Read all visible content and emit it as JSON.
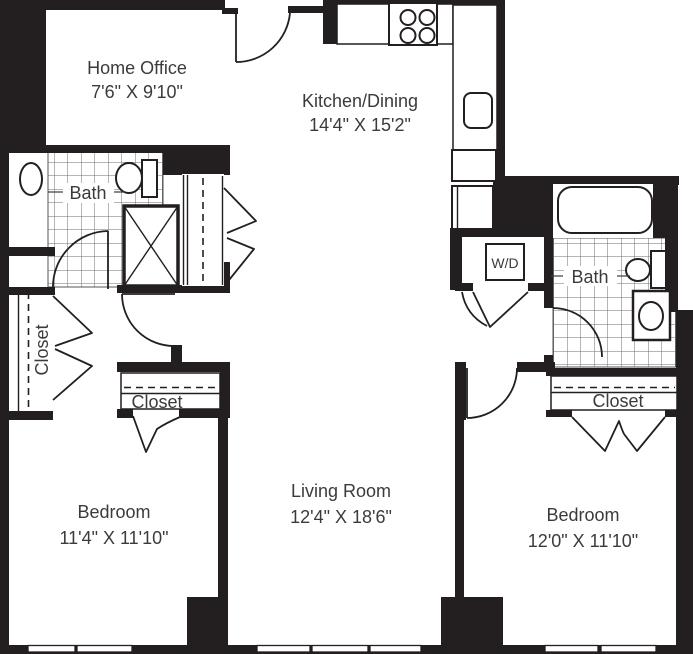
{
  "plan_title": "Two Bedroom Floor Plan",
  "colors": {
    "wall": "#231f20",
    "floor": "#ffffff",
    "tile_line": "#6e6e6e",
    "label": "#3b3b3b"
  },
  "rooms": {
    "home_office": {
      "label": "Home Office",
      "dims": "7'6\" X 9'10\""
    },
    "kitchen_dining": {
      "label": "Kitchen/Dining",
      "dims": "14'4\" X 15'2\""
    },
    "living_room": {
      "label": "Living Room",
      "dims": "12'4\" X 18'6\""
    },
    "bedroom_left": {
      "label": "Bedroom",
      "dims": "11'4\" X 11'10\""
    },
    "bedroom_right": {
      "label": "Bedroom",
      "dims": "12'0\" X 11'10\""
    },
    "bath_left": {
      "label": "Bath"
    },
    "bath_right": {
      "label": "Bath"
    },
    "closet_hall_left": {
      "label": "Closet"
    },
    "closet_bedroom_left": {
      "label": "Closet"
    },
    "closet_bedroom_right": {
      "label": "Closet"
    },
    "laundry": {
      "label": "W/D"
    }
  }
}
